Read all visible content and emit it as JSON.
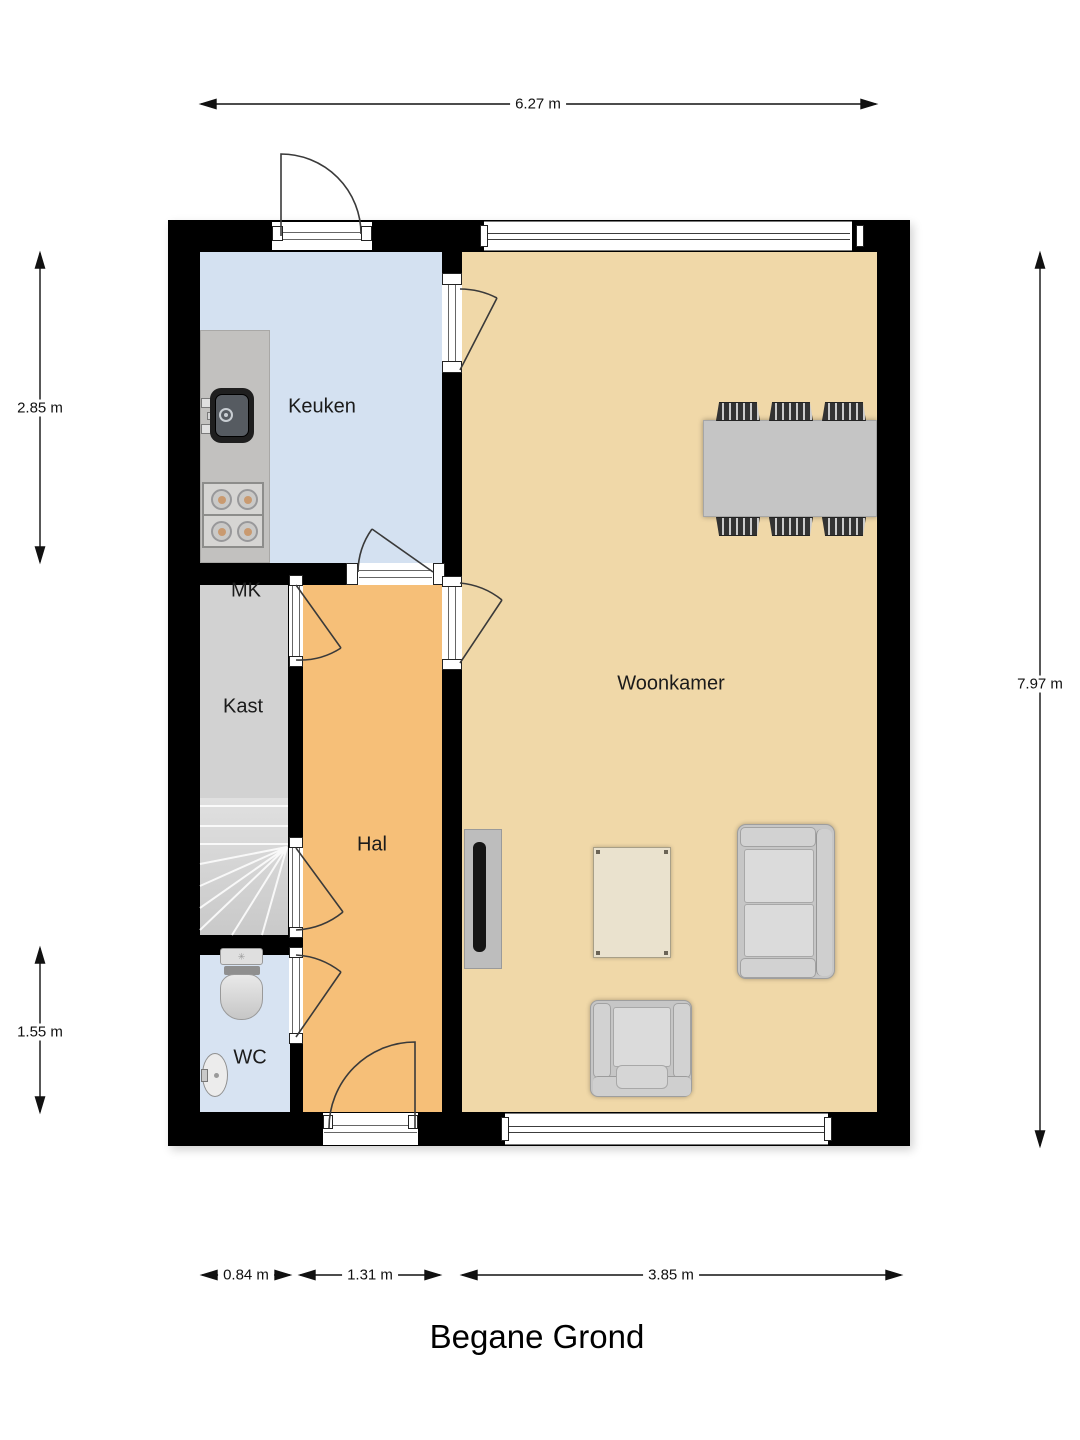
{
  "title": "Begane Grond",
  "rooms": {
    "keuken": "Keuken",
    "mk": "MK",
    "kast": "Kast",
    "hal": "Hal",
    "wc": "WC",
    "woonkamer": "Woonkamer"
  },
  "dimensions": {
    "top_width": "6.27 m",
    "left_upper": "2.85 m",
    "left_lower": "1.55 m",
    "right_height": "7.97 m",
    "bottom_wc": "0.84 m",
    "bottom_hal": "1.31 m",
    "bottom_woonkamer": "3.85 m"
  },
  "icons": {
    "toilet_flush": "✳"
  },
  "colors": {
    "wall": "#000000",
    "keuken-floor": "#d4e1f1",
    "wc-floor": "#d7e3f2",
    "hal-floor": "#f6bf78",
    "woonkamer-floor": "#f0d8a8",
    "kast-floor": "#d2d2d2",
    "counter": "#c2c1bf",
    "table-gray": "#c5c5c5",
    "sofa-gray": "#c6c6c6",
    "cushion-gray": "#dbdbdb",
    "coffee-table": "#eae2ce",
    "tv-black": "#151515",
    "burner-dot": "#c99a70"
  }
}
